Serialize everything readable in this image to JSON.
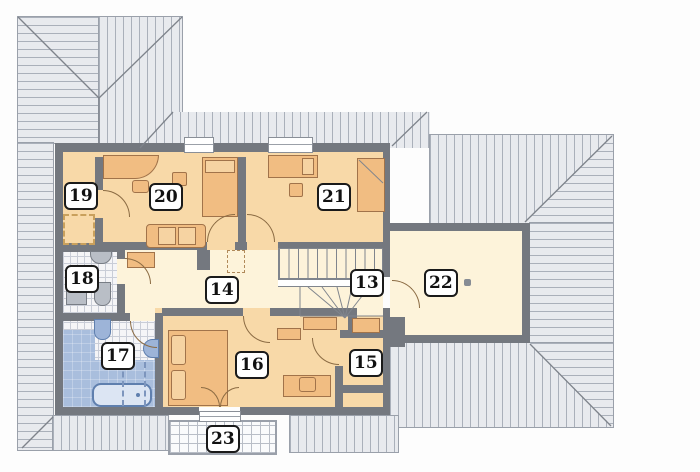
{
  "plan": {
    "title": "attic-floor-plan",
    "rooms": [
      {
        "num": "13",
        "name": "staircase",
        "cx": 364,
        "cy": 283
      },
      {
        "num": "14",
        "name": "hall",
        "cx": 219,
        "cy": 290
      },
      {
        "num": "15",
        "name": "room-15",
        "cx": 363,
        "cy": 363
      },
      {
        "num": "16",
        "name": "bedroom-16",
        "cx": 249,
        "cy": 365
      },
      {
        "num": "17",
        "name": "bathroom",
        "cx": 115,
        "cy": 356
      },
      {
        "num": "18",
        "name": "wc",
        "cx": 79,
        "cy": 279
      },
      {
        "num": "19",
        "name": "room-19",
        "cx": 78,
        "cy": 196
      },
      {
        "num": "20",
        "name": "bedroom-20",
        "cx": 163,
        "cy": 197
      },
      {
        "num": "21",
        "name": "bedroom-21",
        "cx": 331,
        "cy": 197
      },
      {
        "num": "22",
        "name": "attic-room",
        "cx": 438,
        "cy": 283
      },
      {
        "num": "23",
        "name": "balcony",
        "cx": 220,
        "cy": 439
      }
    ],
    "colors": {
      "wall": "#74787f",
      "room": "#f8d9a8",
      "hall": "#fdf3da",
      "furniture": "#f1bd82",
      "furniture_line": "#a1734a",
      "roof": "#e8eaee",
      "roof_line": "#aab0ba",
      "roof_edge": "#9aa0aa",
      "blue": "#a9bedd",
      "blue_line": "#5f7fae",
      "tile_line": "#c9cdd7",
      "label_border": "#1a1a1a"
    }
  }
}
